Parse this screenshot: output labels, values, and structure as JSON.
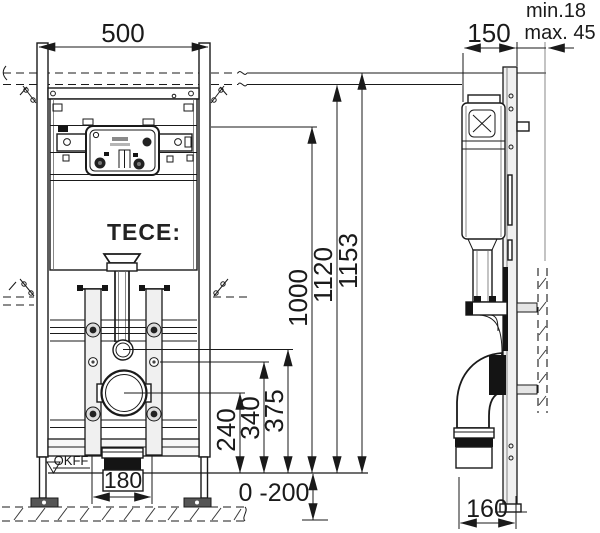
{
  "title_brand": "TECE:",
  "front_view": {
    "dim_width": "500",
    "dim_height_outer": "1153",
    "dim_height_frame": "1120",
    "dim_height_bracket": "1000",
    "dim_water_connection": "375",
    "dim_flush_connection": "340",
    "dim_drain_center": "240",
    "dim_outlet_width": "180",
    "dim_floor_adjust": "0 -200",
    "label_floor_level": "OKFF"
  },
  "side_view": {
    "dim_depth": "150",
    "dim_wall_min": "min.18",
    "dim_wall_max": "max. 45",
    "dim_outlet_depth": "160"
  }
}
